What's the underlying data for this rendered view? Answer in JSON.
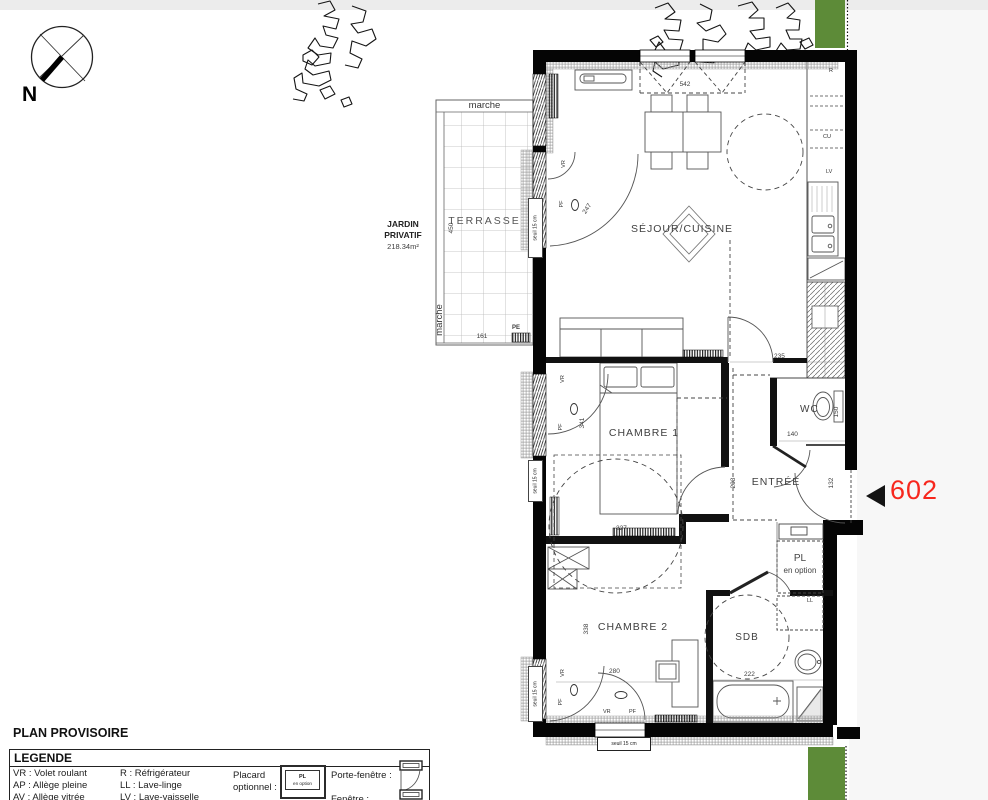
{
  "meta": {
    "top_strip_color": "#ececec",
    "side_area_color": "#f7f7f7",
    "green_color": "#5d8b38",
    "unit_number_color": "#f7271d"
  },
  "compass": {
    "north": "N"
  },
  "garden": {
    "line1": "JARDIN",
    "line2": "PRIVATIF",
    "area": "218.34m²",
    "marche_top": "marche",
    "marche_side": "marche",
    "terrace": "TERRASSE",
    "pe": "PE"
  },
  "unit": {
    "number": "602"
  },
  "rooms": {
    "sejour": "SÉJOUR/CUISINE",
    "chambre1": "CHAMBRE 1",
    "chambre2": "CHAMBRE 2",
    "entree": "ENTRÉE",
    "wc": "WC",
    "sdb": "SDB",
    "pl_line1": "PL",
    "pl_line2": "en option",
    "ll": "LL"
  },
  "kitchen": {
    "r": "R",
    "cu": "CU",
    "lv": "LV"
  },
  "windows": {
    "vr": "VR",
    "pf": "PF",
    "seuil": "seuil 15 cm"
  },
  "dims": {
    "top_window": "542",
    "sejour_door": "247",
    "kitchen_w": "235",
    "terrace_h": "450",
    "terrace_w": "161",
    "ch1_h": "341",
    "ch1_w": "327",
    "ch2_h": "338",
    "ch2_w": "280",
    "entree_h": "203",
    "entree_door": "132",
    "wc_w": "140",
    "wc_h": "150",
    "sdb_w": "222"
  },
  "legend": {
    "provisional": "PLAN PROVISOIRE",
    "title": "LEGENDE",
    "col1": [
      "VR : Volet roulant",
      "AP : Allège pleine",
      "AV : Allège vitrée"
    ],
    "col2": [
      "R : Réfrigérateur",
      "LL : Lave-linge",
      "LV : Lave-vaisselle",
      "CU : Cuisson"
    ],
    "placard_l1": "Placard",
    "placard_l2": "optionnel :",
    "placard_box_l1": "PL",
    "placard_box_l2": "en option",
    "porte_fenetre": "Porte-fenêtre :",
    "fenetre": "Fenêtre :"
  }
}
